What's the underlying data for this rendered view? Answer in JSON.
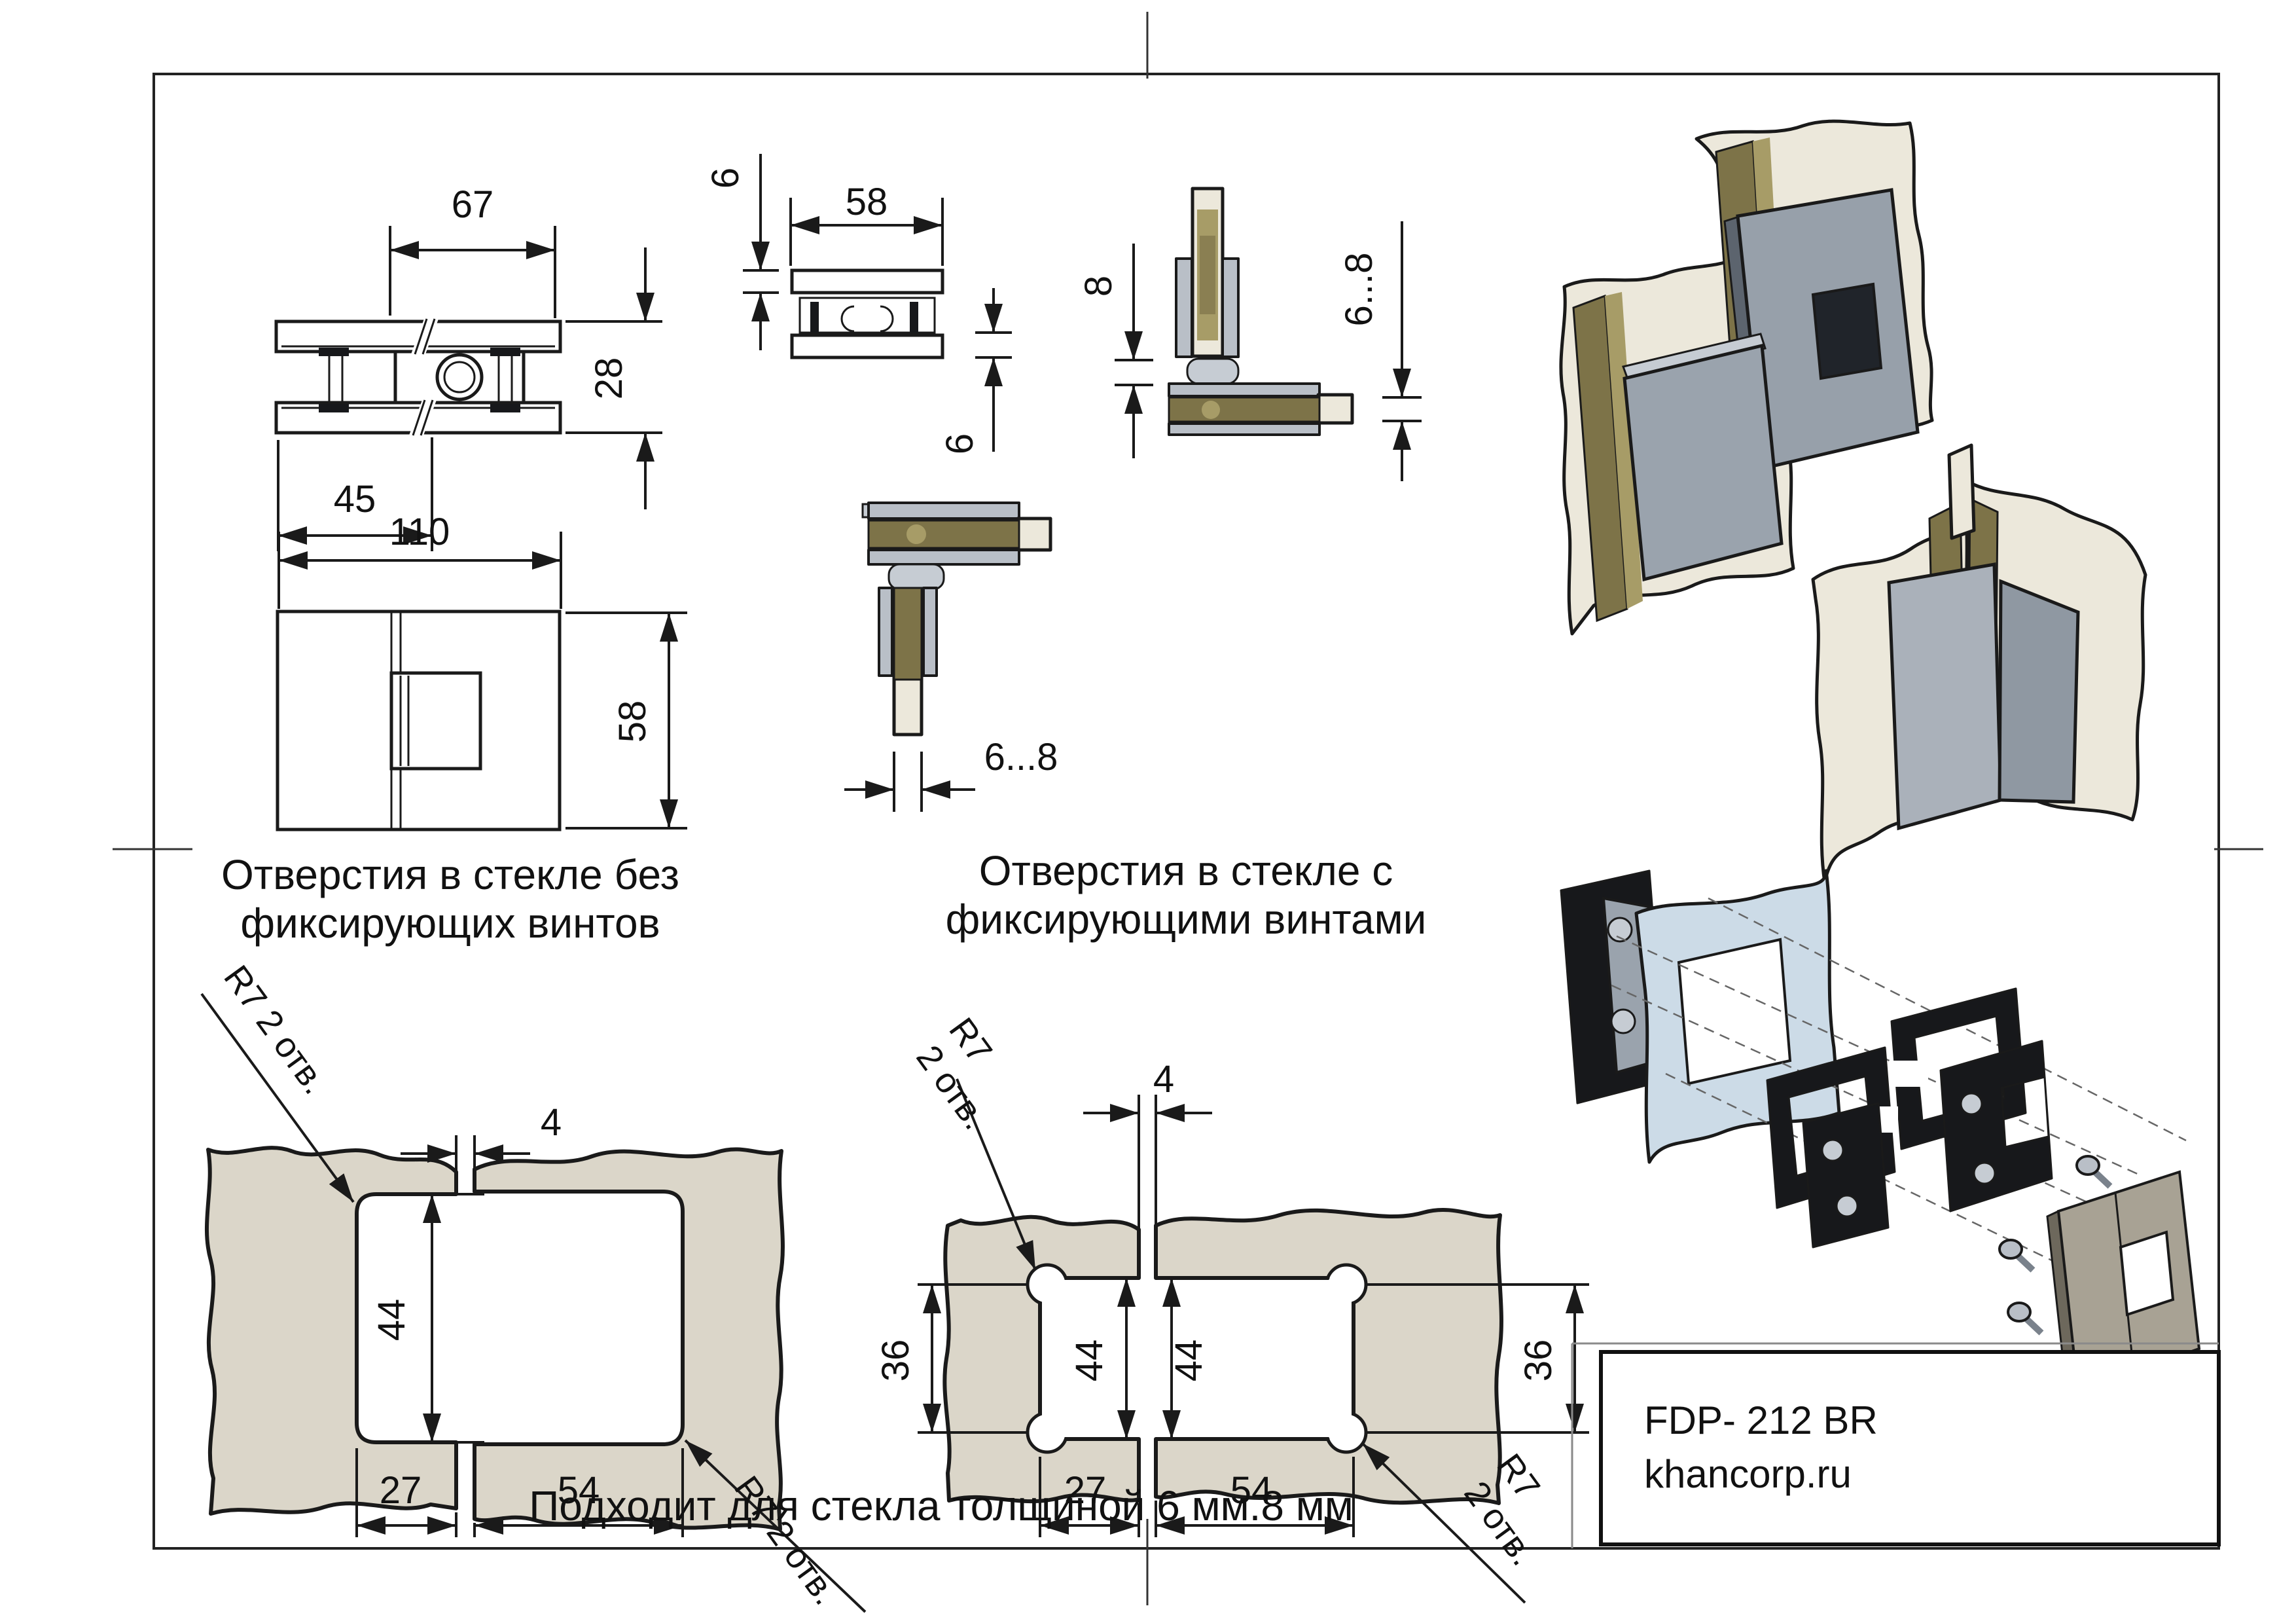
{
  "page": {
    "product_code": "FDP- 212 BR",
    "website": "khancorp.ru",
    "note": "Подходит для стекла толщиной 6 мм.8 мм"
  },
  "views": {
    "plan": {
      "w": "67",
      "h": "28",
      "off": "45"
    },
    "side": {
      "t1": "6",
      "w": "58",
      "t2": "6"
    },
    "corner_side": {
      "off": "8",
      "glass": "6...8"
    },
    "front": {
      "w": "110",
      "h": "58"
    },
    "corner_plan": {
      "glass": "6...8"
    }
  },
  "pattern_left": {
    "title1": "Отверстия в стекле без",
    "title2": "фиксирующих винтов",
    "gap": "4",
    "h": "44",
    "d1": "27",
    "d2": "54",
    "r7_top": "R7 2 отв.",
    "r7_bottom": "R7 2 отв."
  },
  "pattern_right": {
    "title1": "Отверстия в стекле с",
    "title2": "фиксирующими винтами",
    "gap": "4",
    "s1": "36",
    "h1": "44",
    "h2": "44",
    "s2": "36",
    "d1": "27",
    "d2": "54",
    "r7_top_a": "R7",
    "r7_top_b": "2 отв.",
    "r7_bot_a": "R7",
    "r7_bot_b": "2 отв."
  },
  "colors": {
    "line": "#1a1a1a",
    "glass_section": "#dbd6c9",
    "glass_3d": "#ece8db",
    "glass_edge_olive": "#7d7348",
    "metal_light": "#b9bfc7",
    "gasket_black": "#17181b",
    "glass_blue": "#ccdbe7",
    "cover_tan": "#a8a294",
    "accent_orange": "#d99a2b"
  }
}
